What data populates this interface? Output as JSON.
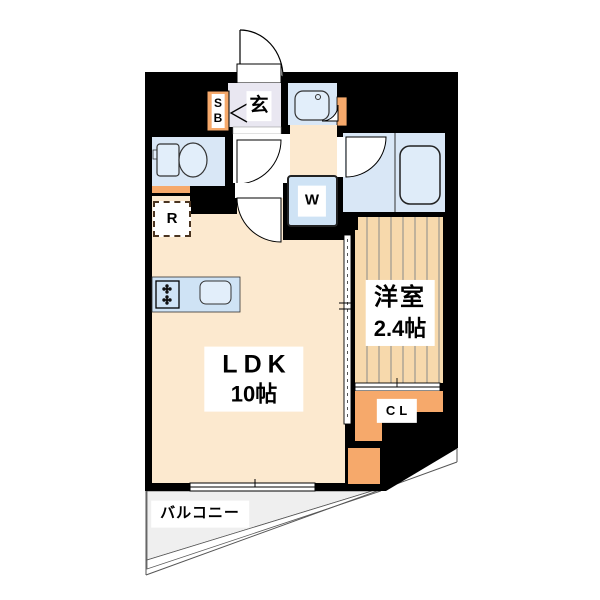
{
  "plan": {
    "type": "apartment-floor-plan",
    "labels": {
      "ldk_line1": "LDK",
      "ldk_line2": "10帖",
      "western_room_line1": "洋室",
      "western_room_line2": "2.4帖",
      "closet": "CL",
      "washing_machine": "W",
      "refrigerator": "R",
      "shoe_box_line1": "S",
      "shoe_box_line2": "B",
      "entrance": "玄",
      "balcony": "バルコニー"
    },
    "colors": {
      "wall": "#000000",
      "ldk_floor": "#fce9cf",
      "western_room_floor": "#f7d9ac",
      "wet_area": "#d9e7f6",
      "fixture": "#e2eefa",
      "accent_orange": "#f6a96b",
      "entrance_floor": "#e9e7f1",
      "balcony_floor": "#efefef"
    }
  }
}
